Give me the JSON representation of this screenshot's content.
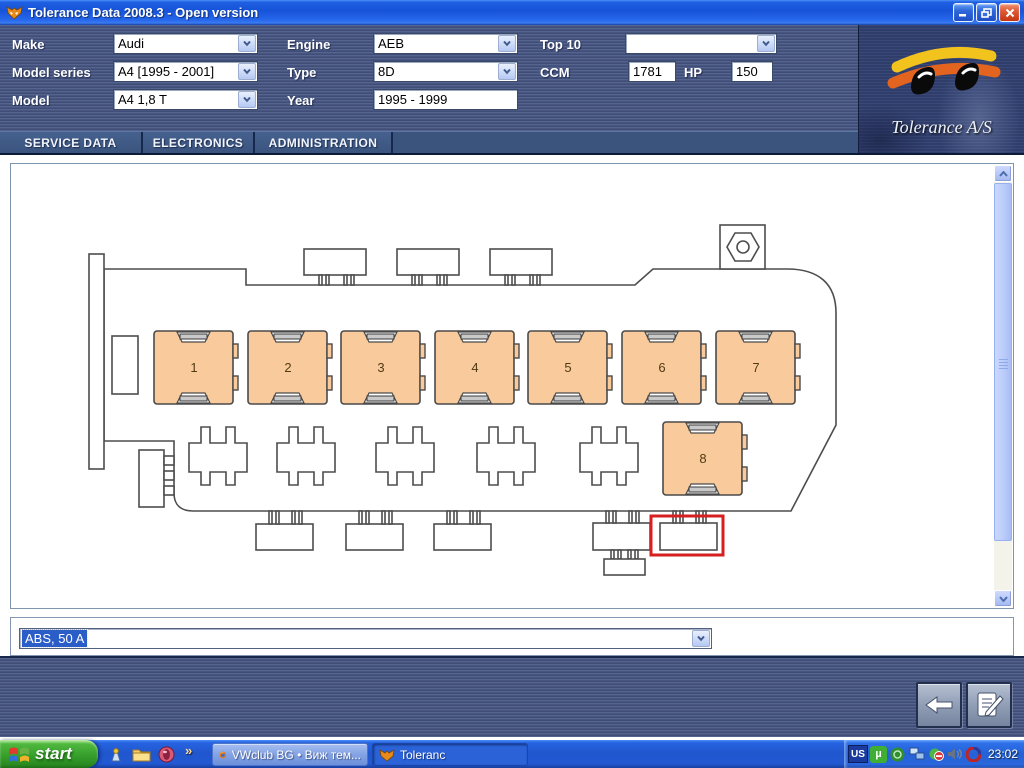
{
  "window": {
    "title": "Tolerance Data 2008.3 - Open version"
  },
  "header": {
    "make": {
      "label": "Make",
      "value": "Audi"
    },
    "model_series": {
      "label": "Model series",
      "value": "A4 [1995 - 2001]"
    },
    "model": {
      "label": "Model",
      "value": "A4 1,8 T"
    },
    "engine": {
      "label": "Engine",
      "value": "AEB"
    },
    "type": {
      "label": "Type",
      "value": "8D"
    },
    "year": {
      "label": "Year",
      "value": "1995 - 1999"
    },
    "top10": {
      "label": "Top 10",
      "value": ""
    },
    "ccm": {
      "label": "CCM",
      "value": "1781"
    },
    "hp": {
      "label": "HP",
      "value": "150"
    },
    "brand": "Tolerance A/S"
  },
  "tabs": [
    {
      "label": "SERVICE DATA"
    },
    {
      "label": "ELECTRONICS"
    },
    {
      "label": "ADMINISTRATION"
    }
  ],
  "diagram": {
    "type": "fuse-relay-box",
    "relays": [
      "1",
      "2",
      "3",
      "4",
      "5",
      "6",
      "7",
      "8"
    ],
    "relay_fill": "#F9CB9C",
    "selected_fuse_outline": "#D62020"
  },
  "fuse_select": {
    "value": "ABS, 50 A",
    "selection_color": "#2B5DC9"
  },
  "bottom_toolbar": {
    "back": "back",
    "report": "report"
  },
  "taskbar": {
    "start_label": "start",
    "overflow_chevron": "»",
    "tasks": [
      {
        "label": "VWclub BG • Виж тем...",
        "icon": "firefox-icon",
        "state": "normal"
      },
      {
        "label": "Toleranc",
        "icon": "fox-icon",
        "state": "active"
      }
    ],
    "tray": {
      "language": "US",
      "utorrent_glyph": "µ",
      "time": "23:02"
    }
  },
  "colors": {
    "taskbar_blue": "#2056CD",
    "start_green": "#379F2C",
    "header_steel": "#47557F",
    "titlebar_blue": "#1F5FE0"
  }
}
